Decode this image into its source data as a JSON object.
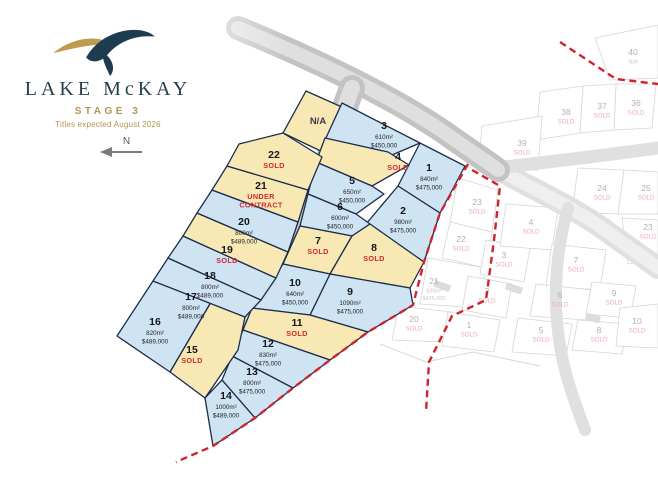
{
  "brand": {
    "name": "LAKE McKAY",
    "stage": "STAGE 3",
    "titles_note": "Titles expected August 2026"
  },
  "compass": {
    "label": "N"
  },
  "colors": {
    "navy": "#24404f",
    "gold": "#b2954f",
    "available_fill": "#cfe4f2",
    "sold_fill": "#f8e8b4",
    "lot_border": "#1c2c4d",
    "sold_text": "#d42a2e",
    "dash_red": "#d0242c",
    "faded_text": "#b9aeae",
    "faded_sold": "#efa9b2",
    "faded_border": "#d8d4d4"
  },
  "stage3": {
    "lots": [
      {
        "id": "na",
        "label": "N/A",
        "status": "na",
        "sub": []
      },
      {
        "id": "1",
        "label": "1",
        "status": "available",
        "sub": [
          "840m²",
          "$475,000"
        ]
      },
      {
        "id": "2",
        "label": "2",
        "status": "available",
        "sub": [
          "980m²",
          "$475,000"
        ]
      },
      {
        "id": "3",
        "label": "3",
        "status": "available",
        "sub": [
          "610m²",
          "$450,000"
        ]
      },
      {
        "id": "4",
        "label": "4",
        "status": "sold",
        "sub": [
          "SOLD"
        ]
      },
      {
        "id": "5",
        "label": "5",
        "status": "available",
        "sub": [
          "650m²",
          "$450,000"
        ]
      },
      {
        "id": "6",
        "label": "6",
        "status": "available",
        "sub": [
          "600m²",
          "$450,000"
        ]
      },
      {
        "id": "7",
        "label": "7",
        "status": "sold",
        "sub": [
          "SOLD"
        ]
      },
      {
        "id": "8",
        "label": "8",
        "status": "sold",
        "sub": [
          "SOLD"
        ]
      },
      {
        "id": "9",
        "label": "9",
        "status": "available",
        "sub": [
          "1090m²",
          "$475,000"
        ]
      },
      {
        "id": "10",
        "label": "10",
        "status": "available",
        "sub": [
          "640m²",
          "$450,000"
        ]
      },
      {
        "id": "11",
        "label": "11",
        "status": "sold",
        "sub": [
          "SOLD"
        ]
      },
      {
        "id": "12",
        "label": "12",
        "status": "available",
        "sub": [
          "830m²",
          "$475,000"
        ]
      },
      {
        "id": "13",
        "label": "13",
        "status": "available",
        "sub": [
          "800m²",
          "$475,000"
        ]
      },
      {
        "id": "14",
        "label": "14",
        "status": "available",
        "sub": [
          "1000m²",
          "$489,000"
        ]
      },
      {
        "id": "15",
        "label": "15",
        "status": "sold",
        "sub": [
          "SOLD"
        ]
      },
      {
        "id": "16",
        "label": "16",
        "status": "available",
        "sub": [
          "820m²",
          "$489,000"
        ]
      },
      {
        "id": "17",
        "label": "17",
        "status": "available",
        "sub": [
          "800m²",
          "$489,000"
        ]
      },
      {
        "id": "18",
        "label": "18",
        "status": "available",
        "sub": [
          "800m²",
          "$489,000"
        ]
      },
      {
        "id": "19",
        "label": "19",
        "status": "sold",
        "sub": [
          "SOLD"
        ]
      },
      {
        "id": "20",
        "label": "20",
        "status": "available",
        "sub": [
          "800m²",
          "$489,000"
        ]
      },
      {
        "id": "21",
        "label": "21",
        "status": "under-contract",
        "sub": [
          "UNDER",
          "CONTRACT"
        ]
      },
      {
        "id": "22",
        "label": "22",
        "status": "sold",
        "sub": [
          "SOLD"
        ]
      }
    ]
  },
  "other_stages": {
    "lots": [
      {
        "id": "f40",
        "label": "40",
        "status": "faded",
        "sub": [
          "N/A"
        ]
      },
      {
        "id": "f36",
        "label": "36",
        "status": "faded",
        "sub": [
          "SOLD"
        ]
      },
      {
        "id": "f37",
        "label": "37",
        "status": "faded",
        "sub": [
          "SOLD"
        ]
      },
      {
        "id": "f38",
        "label": "38",
        "status": "faded",
        "sub": [
          "SOLD"
        ]
      },
      {
        "id": "f39",
        "label": "39",
        "status": "faded",
        "sub": [
          "SOLD"
        ]
      },
      {
        "id": "f24",
        "label": "24",
        "status": "faded",
        "sub": [
          "SOLD"
        ]
      },
      {
        "id": "f25",
        "label": "25",
        "status": "faded",
        "sub": [
          "SOLD"
        ]
      },
      {
        "id": "f23r",
        "label": "23",
        "status": "faded",
        "sub": [
          "SOLD"
        ]
      },
      {
        "id": "f23",
        "label": "23",
        "status": "faded",
        "sub": [
          "SOLD"
        ]
      },
      {
        "id": "f22",
        "label": "22",
        "status": "faded",
        "sub": [
          "SOLD"
        ]
      },
      {
        "id": "f21",
        "label": "21",
        "status": "faded",
        "sub": [
          "500m²",
          "$425,000"
        ]
      },
      {
        "id": "f20",
        "label": "20",
        "status": "faded",
        "sub": [
          "SOLD"
        ]
      },
      {
        "id": "f3",
        "label": "3",
        "status": "faded",
        "sub": [
          "SOLD"
        ]
      },
      {
        "id": "f2",
        "label": "2",
        "status": "faded",
        "sub": [
          "SOLD"
        ]
      },
      {
        "id": "f1",
        "label": "1",
        "status": "faded",
        "sub": [
          "SOLD"
        ]
      },
      {
        "id": "f4",
        "label": "4",
        "status": "faded",
        "sub": [
          "SOLD"
        ]
      },
      {
        "id": "f7",
        "label": "7",
        "status": "faded",
        "sub": [
          "SOLD"
        ]
      },
      {
        "id": "f6",
        "label": "6",
        "status": "faded",
        "sub": [
          "SOLD"
        ]
      },
      {
        "id": "f5",
        "label": "5",
        "status": "faded",
        "sub": [
          "SOLD"
        ]
      },
      {
        "id": "f9",
        "label": "9",
        "status": "faded",
        "sub": [
          "SOLD"
        ]
      },
      {
        "id": "f8",
        "label": "8",
        "status": "faded",
        "sub": [
          "SOLD"
        ]
      },
      {
        "id": "f10",
        "label": "10",
        "status": "faded",
        "sub": [
          "SOLD"
        ]
      }
    ]
  }
}
